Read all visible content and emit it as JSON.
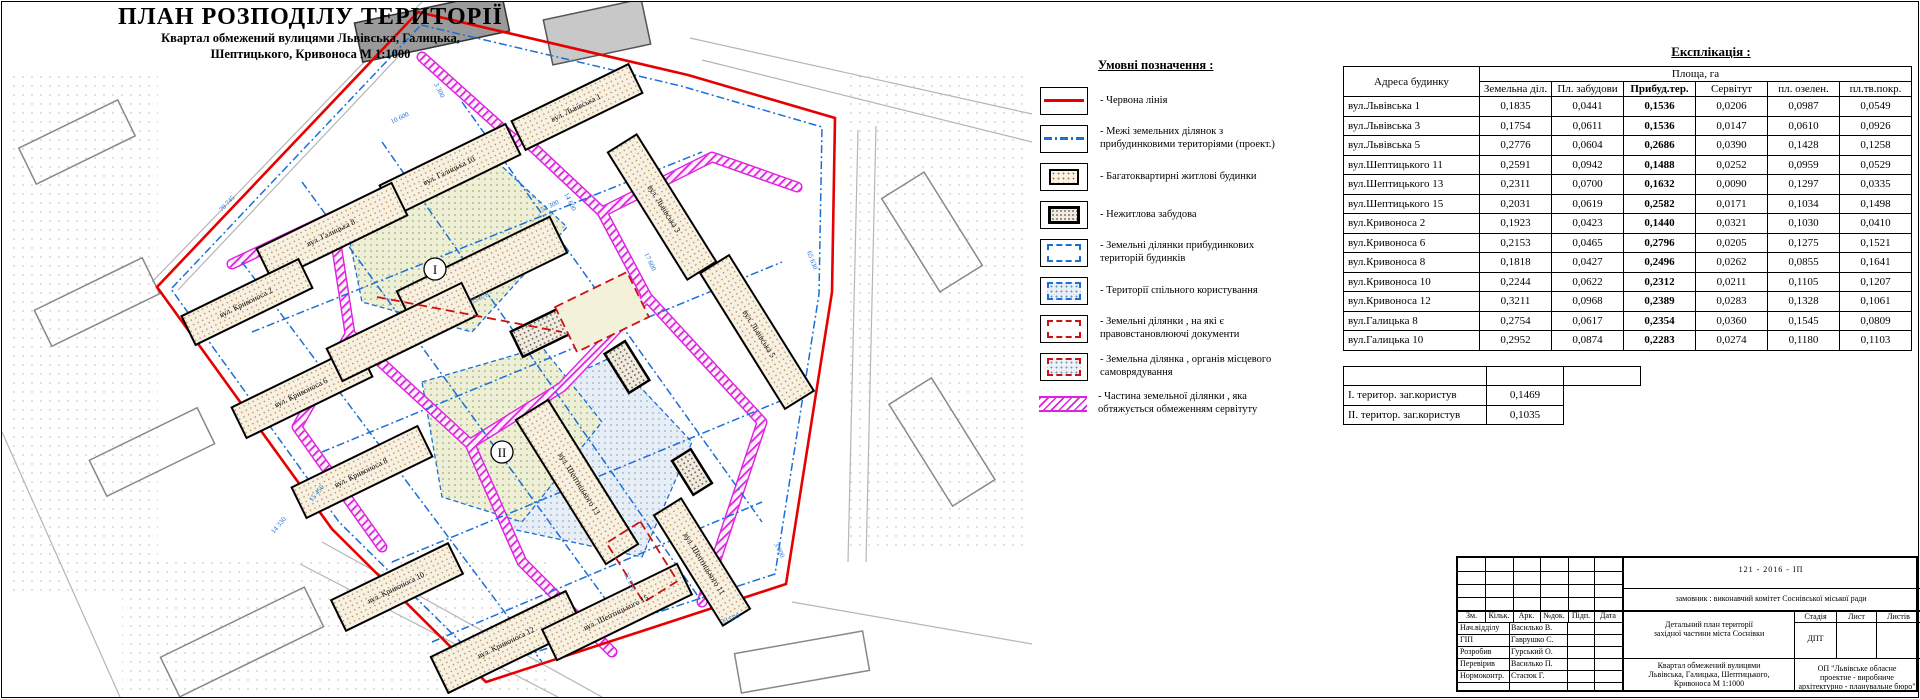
{
  "sheet": {
    "title": "ПЛАН РОЗПОДІЛУ ТЕРИТОРІЇ",
    "subtitle_line1": "Квартал обмежений вулицями Львівська, Галицька,",
    "subtitle_line2": "Шептицького, Кривоноса  М 1:1000"
  },
  "legend": {
    "title": "Умовні позначення :",
    "items": [
      {
        "key": "red-line",
        "label": "- Червона лінія"
      },
      {
        "key": "parcel-boundaries",
        "label": "- Межі земельних ділянок з прибудинковими територіями (проект.)"
      },
      {
        "key": "apartment-buildings",
        "label": "- Багатоквартирні житлові будинки"
      },
      {
        "key": "non-residential",
        "label": "- Нежитлова забудова"
      },
      {
        "key": "house-parcels",
        "label": "- Земельні ділянки прибудинкових територій будинків"
      },
      {
        "key": "common-territories",
        "label": "- Території спільного користування"
      },
      {
        "key": "titled-parcels",
        "label": "- Земельні ділянки , на які є правовстановлюючі документи"
      },
      {
        "key": "municipal-parcel",
        "label": "- Земельна ділянка , органів місцевого самоврядування"
      },
      {
        "key": "servitude-part",
        "label": "- Частина земельної ділянки , яка обтяжується обмеженням сервітуту"
      }
    ]
  },
  "explication": {
    "title": "Експлікація :",
    "address_header": "Адреса  будинку",
    "area_header": "Площа, га",
    "columns": [
      "Земельна діл.",
      "Пл. забудови",
      "Прибуд.тер.",
      "Сервітут",
      "пл. озелен.",
      "пл.тв.покр."
    ],
    "rows": [
      {
        "address": "вул.Львівська 1",
        "values": [
          "0,1835",
          "0,0441",
          "0,1536",
          "0,0206",
          "0,0987",
          "0,0549"
        ]
      },
      {
        "address": "вул.Львівська 3",
        "values": [
          "0,1754",
          "0,0611",
          "0,1536",
          "0,0147",
          "0,0610",
          "0,0926"
        ]
      },
      {
        "address": "вул.Львівська 5",
        "values": [
          "0,2776",
          "0,0604",
          "0,2686",
          "0,0390",
          "0,1428",
          "0,1258"
        ]
      },
      {
        "address": "вул.Шептицького 11",
        "values": [
          "0,2591",
          "0,0942",
          "0,1488",
          "0,0252",
          "0,0959",
          "0,0529"
        ]
      },
      {
        "address": "вул.Шептицького 13",
        "values": [
          "0,2311",
          "0,0700",
          "0,1632",
          "0,0090",
          "0,1297",
          "0,0335"
        ]
      },
      {
        "address": "вул.Шептицького 15",
        "values": [
          "0,2031",
          "0,0619",
          "0,2582",
          "0,0171",
          "0,1034",
          "0,1498"
        ]
      },
      {
        "address": "вул.Кривоноса  2",
        "values": [
          "0,1923",
          "0,0423",
          "0,1440",
          "0,0321",
          "0,1030",
          "0,0410"
        ]
      },
      {
        "address": "вул.Кривоноса  6",
        "values": [
          "0,2153",
          "0,0465",
          "0,2796",
          "0,0205",
          "0,1275",
          "0,1521"
        ]
      },
      {
        "address": "вул.Кривоноса  8",
        "values": [
          "0,1818",
          "0,0427",
          "0,2496",
          "0,0262",
          "0,0855",
          "0,1641"
        ]
      },
      {
        "address": "вул.Кривоноса  10",
        "values": [
          "0,2244",
          "0,0622",
          "0,2312",
          "0,0211",
          "0,1105",
          "0,1207"
        ]
      },
      {
        "address": "вул.Кривоноса  12",
        "values": [
          "0,3211",
          "0,0968",
          "0,2389",
          "0,0283",
          "0,1328",
          "0,1061"
        ]
      },
      {
        "address": "вул.Галицька 8",
        "values": [
          "0,2754",
          "0,0617",
          "0,2354",
          "0,0360",
          "0,1545",
          "0,0809"
        ]
      },
      {
        "address": "вул.Галицька 10",
        "values": [
          "0,2952",
          "0,0874",
          "0,2283",
          "0,0274",
          "0,1180",
          "0,1103"
        ]
      }
    ],
    "totals": [
      {
        "label": "І. територ. заг.користув",
        "value": "0,1469"
      },
      {
        "label": "ІІ. територ. заг.користув",
        "value": "0,1035"
      }
    ]
  },
  "stamp": {
    "code": "121 - 2016 - ІП",
    "client": "замовник : виконавчий комітет Соснівської міської ради",
    "rev_columns": [
      "Зм.",
      "Кільк.",
      "Арк.",
      "№док.",
      "Підп.",
      "Дата"
    ],
    "roles": [
      {
        "label": "Нач.відділу",
        "name": "Василько В."
      },
      {
        "label": "ГІП",
        "name": "Гаврушко С."
      },
      {
        "label": "Розробив",
        "name": "Гурський О."
      },
      {
        "label": "Перевірив",
        "name": "Василько П."
      },
      {
        "label": "Нормоконтр.",
        "name": "Стасюк Г."
      }
    ],
    "project_line1": "Детальний план території",
    "project_line2": "західної частини міста Соснівки",
    "stage_columns": [
      "Стадія",
      "Лист",
      "Листів"
    ],
    "stage": "ДПТ",
    "object_line1": "Квартал обмежений вулицями",
    "object_line2": "Львівська, Галицька, Шептицького,",
    "object_line3": "Кривоноса  М 1:1000",
    "org_line1": "ОП \"Львівське обласне",
    "org_line2": "проектне - виробниче",
    "org_line3": "архітектурно - планувальне бюро\""
  },
  "map": {
    "zone_markers": [
      "І",
      "ІІ"
    ],
    "building_labels": [
      "вул. Галицька 10",
      "вул. Галицька 8",
      "вул. Львівська 1",
      "вул. Львівська 3",
      "вул. Львівська 5",
      "вул. Кривоноса 2",
      "вул. Кривоноса 6",
      "вул. Кривоноса 8",
      "вул. Кривоноса 10",
      "вул. Кривоноса 12",
      "вул. Шептицького 11",
      "вул. Шептицького 13",
      "вул. Шептицького 15"
    ],
    "dimensions": [
      "70 745",
      "65 630",
      "55 678",
      "52 300",
      "52 020",
      "23 500",
      "17 600",
      "14 600",
      "15 450",
      "14 330",
      "10 600",
      "3 300",
      "3 000"
    ]
  },
  "colors": {
    "red_line": "#e60000",
    "servitude_magenta": "#dd22dd",
    "parcel_blue": "#1b6fd6"
  }
}
